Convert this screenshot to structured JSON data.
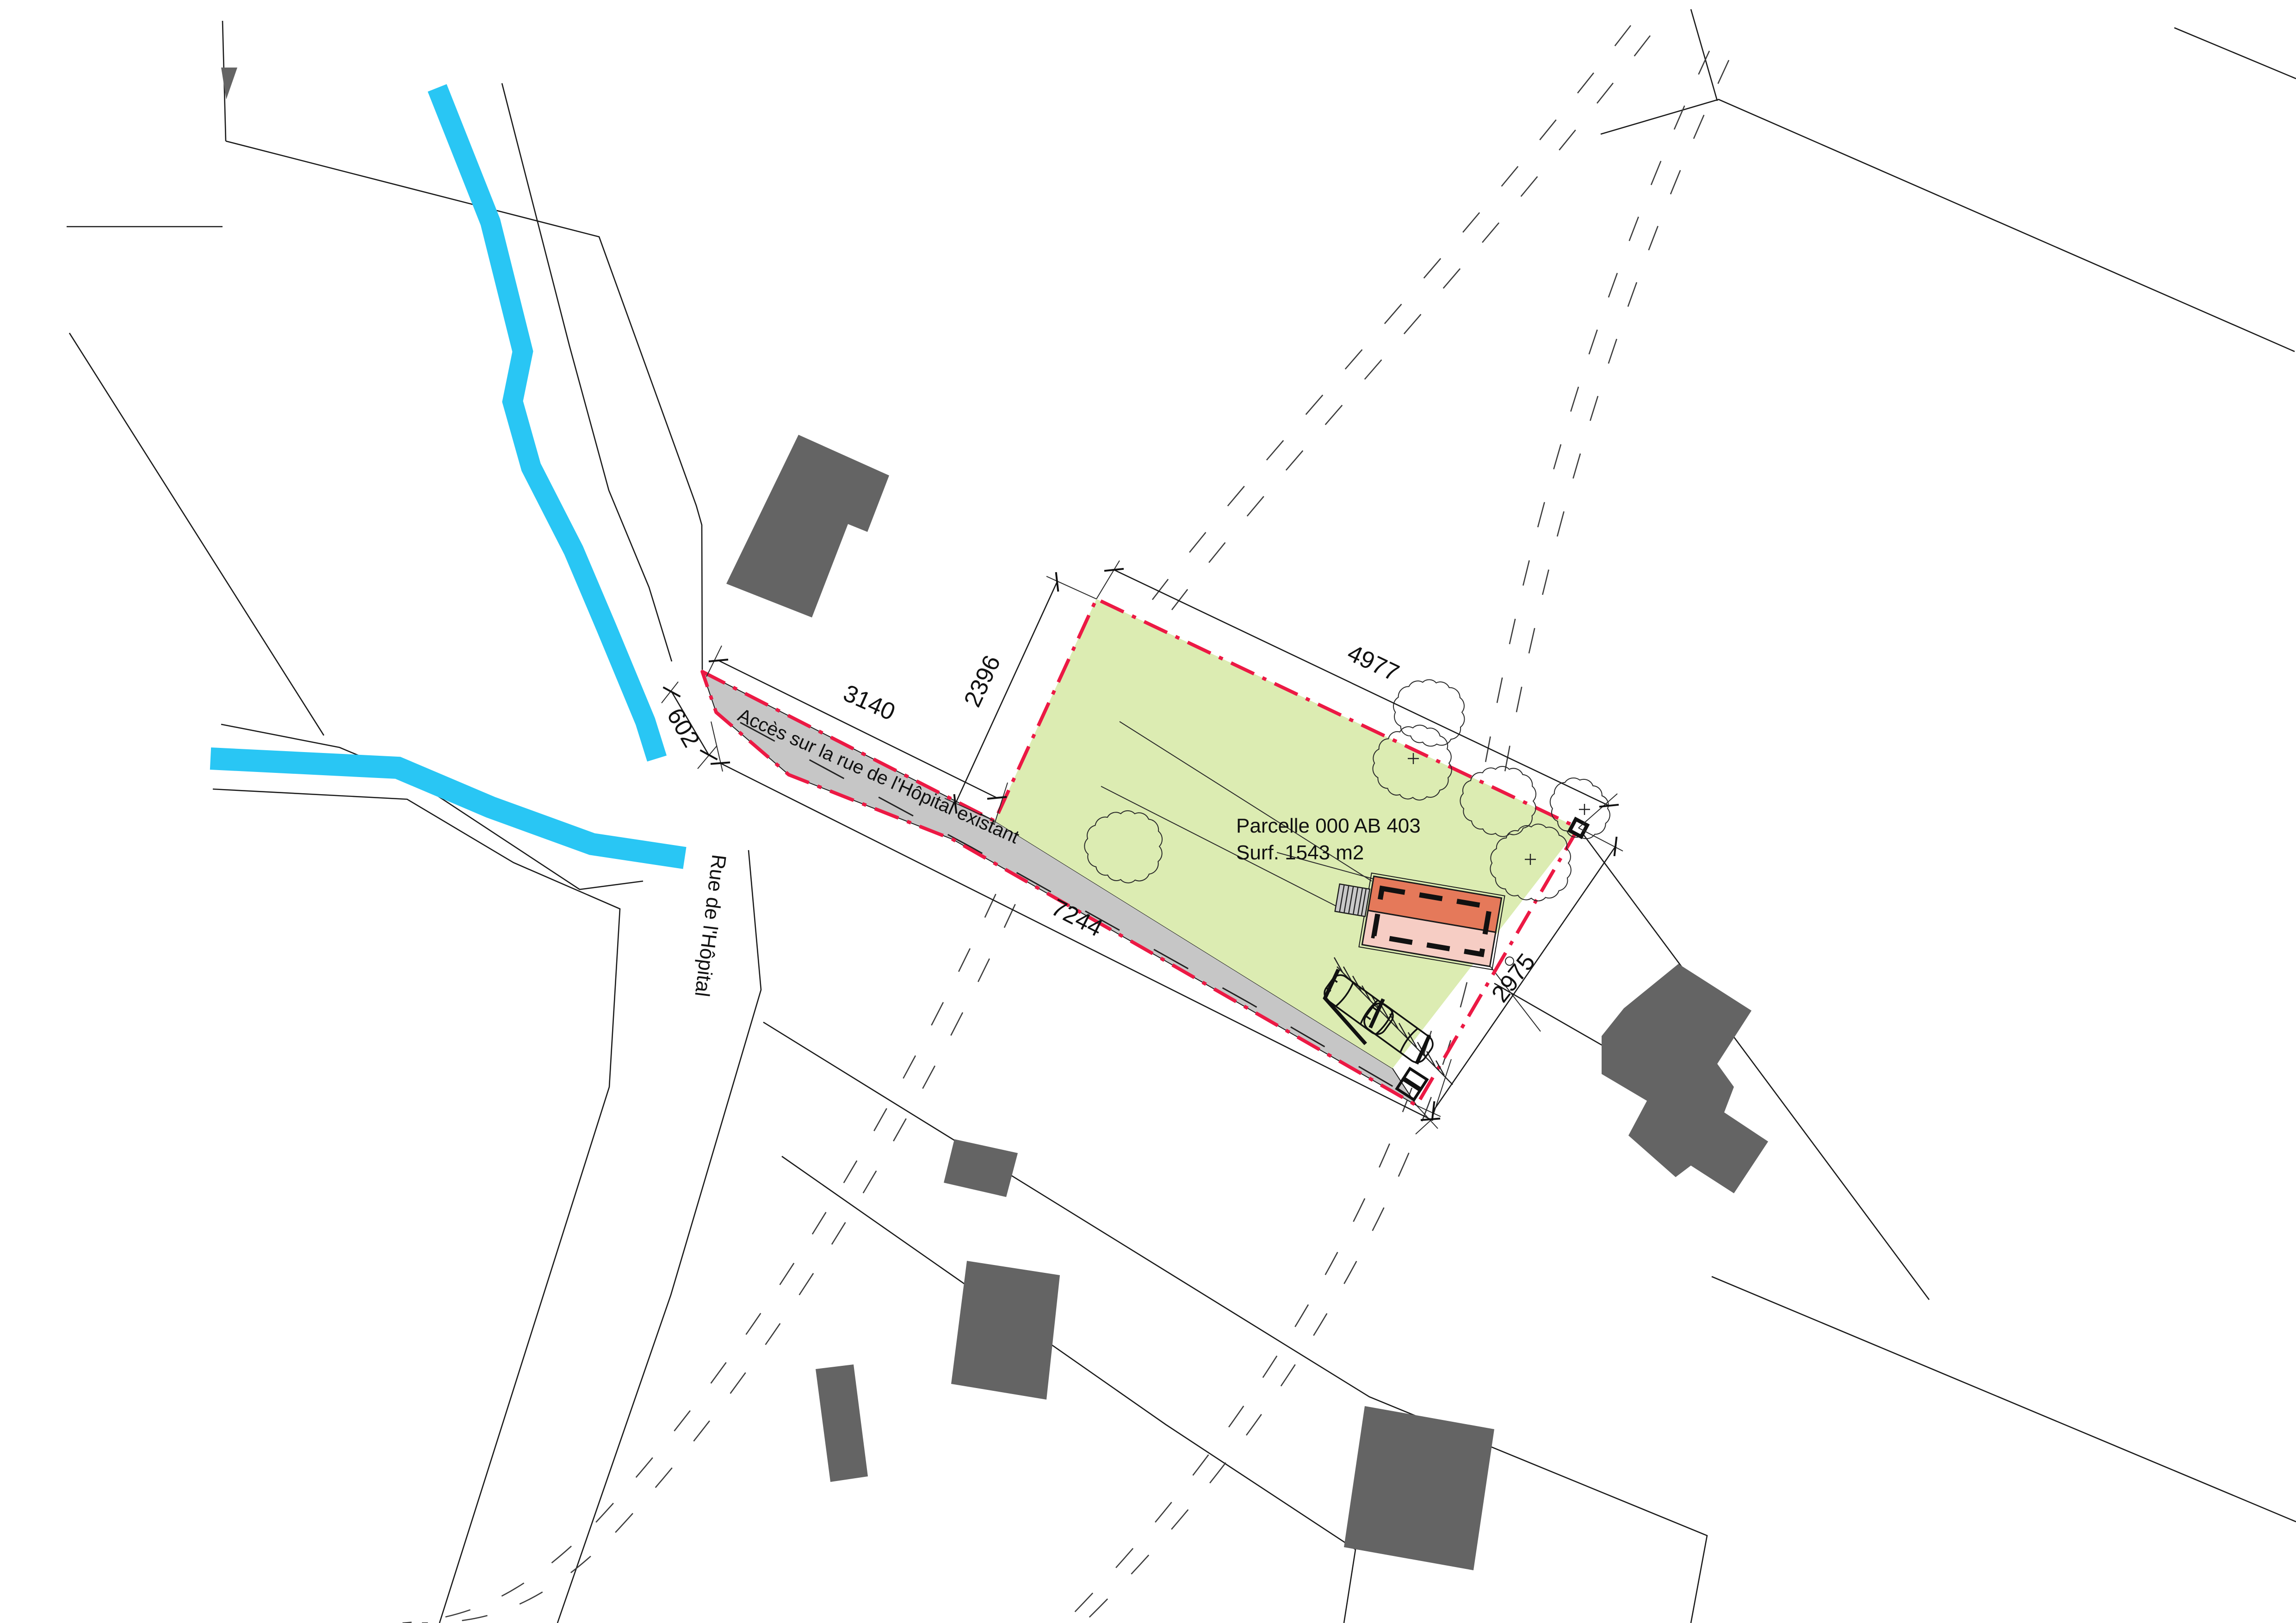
{
  "plan": {
    "parcel": {
      "label_line1": "Parcelle 000 AB 403",
      "label_line2": "Surf. 1543 m2"
    },
    "roads": {
      "access_label": "Accès sur la rue de l'Hôpital existant",
      "street_label": "Rue de l'Hôpital"
    },
    "dimensions": {
      "access_length": "3140",
      "access_width": "602",
      "parcel_west": "2396",
      "parcel_north": "4977",
      "frontage_total": "7244",
      "parcel_southeast": "2975"
    },
    "colors": {
      "parcel_fill": "#dcecb2",
      "road_fill": "#c6c6c6",
      "building_existing": "#646464",
      "building_new_dark": "#e5795a",
      "building_new_light": "#f6cdc4",
      "boundary_red": "#ec1944",
      "stream_blue": "#29c6f4",
      "line_black": "#1a1a1a"
    }
  }
}
